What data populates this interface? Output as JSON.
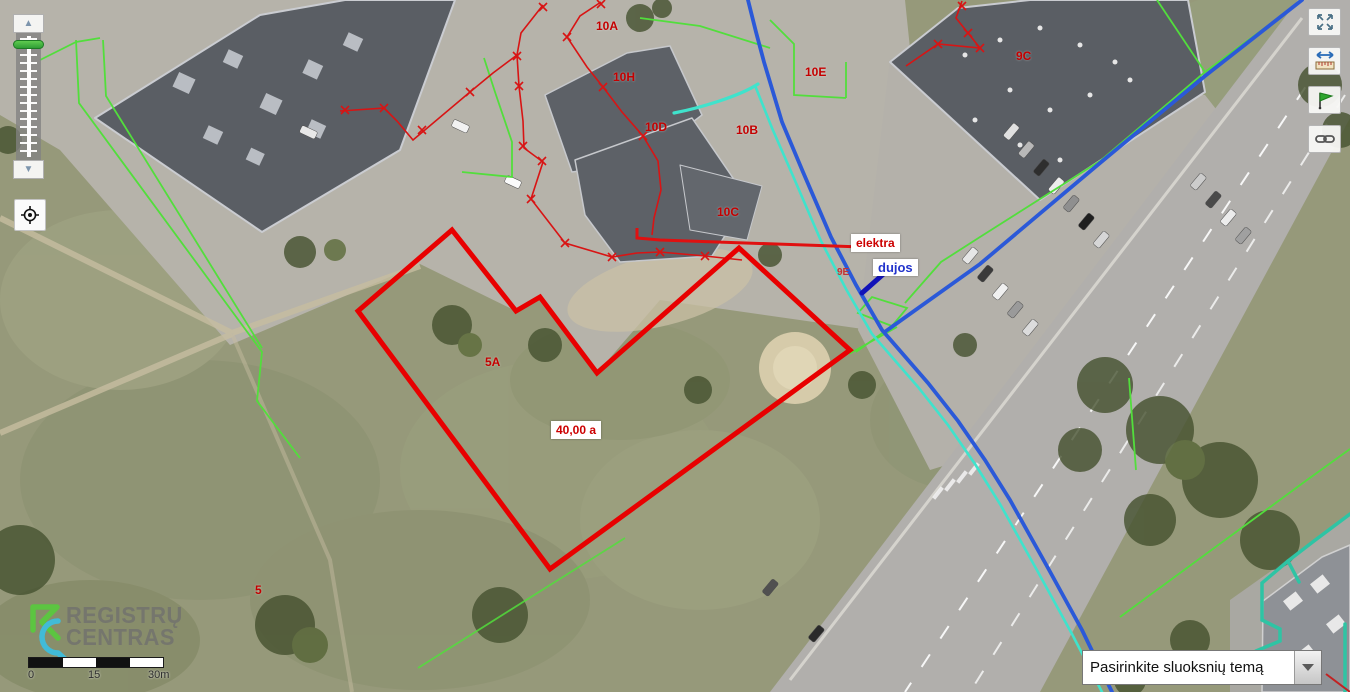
{
  "map": {
    "labels": [
      {
        "id": "10A",
        "text": "10A",
        "x": 596,
        "y": 19,
        "style": "red"
      },
      {
        "id": "10H",
        "text": "10H",
        "x": 613,
        "y": 70,
        "style": "red"
      },
      {
        "id": "10D",
        "text": "10D",
        "x": 645,
        "y": 120,
        "style": "red"
      },
      {
        "id": "10E",
        "text": "10E",
        "x": 805,
        "y": 65,
        "style": "red"
      },
      {
        "id": "10B",
        "text": "10B",
        "x": 736,
        "y": 123,
        "style": "red"
      },
      {
        "id": "10C",
        "text": "10C",
        "x": 717,
        "y": 205,
        "style": "red"
      },
      {
        "id": "9C",
        "text": "9C",
        "x": 1016,
        "y": 49,
        "style": "red"
      },
      {
        "id": "9E",
        "text": "9E",
        "x": 837,
        "y": 267,
        "style": "red-small"
      },
      {
        "id": "5A",
        "text": "5A",
        "x": 485,
        "y": 355,
        "style": "red"
      },
      {
        "id": "5",
        "text": "5",
        "x": 255,
        "y": 583,
        "style": "red"
      },
      {
        "id": "area-40a",
        "text": "40,00 a",
        "x": 551,
        "y": 421,
        "style": "red-boxed"
      },
      {
        "id": "elektra",
        "text": "elektra",
        "x": 851,
        "y": 234,
        "style": "red-boxed"
      },
      {
        "id": "dujos",
        "text": "dujos",
        "x": 873,
        "y": 259,
        "style": "blue-boxed"
      }
    ],
    "colors": {
      "parcel_selected": "#e80000",
      "cadastre_green": "#52de3c",
      "water_blue": "#2b59d8",
      "gas_navy": "#1212b8",
      "utility_teal": "#2ec4a4",
      "label_red": "#c40000",
      "label_blue": "#2233cc"
    }
  },
  "controls": {
    "zoom_in_icon": "▲",
    "zoom_out_icon": "▼",
    "icons": [
      "zoom-in",
      "zoom-out",
      "zoom-slider",
      "locate",
      "fullscreen",
      "measure",
      "flag",
      "link",
      "dropdown-arrow"
    ]
  },
  "logo": {
    "line1": "REGISTRŲ",
    "line2": "CENTRAS"
  },
  "scale_bar": {
    "labels": [
      "0",
      "15",
      "30m"
    ]
  },
  "layer_dropdown": {
    "value": "Pasirinkite sluoksnių temą"
  }
}
